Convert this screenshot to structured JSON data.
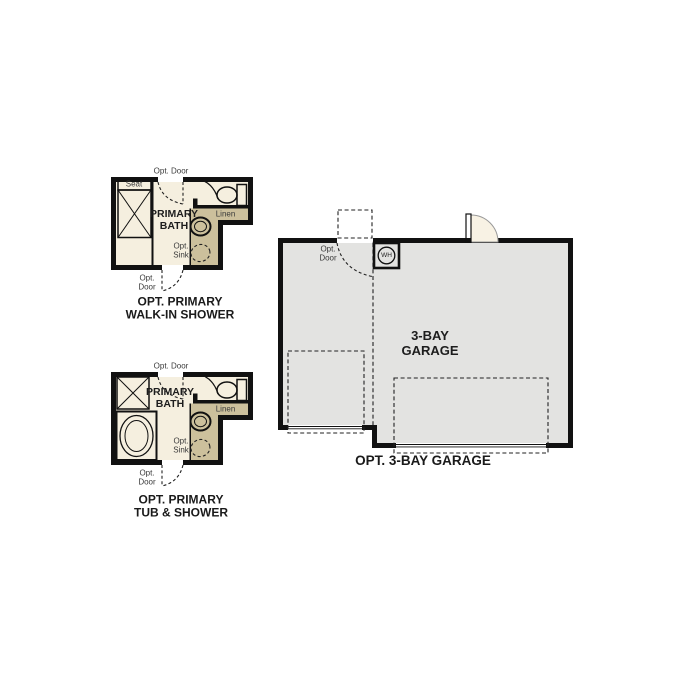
{
  "colors": {
    "wall_black": "#111111",
    "bath_floor_cream": "#f5efdf",
    "garage_floor_gray": "#e3e3e1",
    "cabinet_tan": "#ccc09c",
    "fixture_blue": "#b9d0e8",
    "door_swing_cream": "#f8f2e4",
    "background": "#ffffff"
  },
  "plan_walk_in_shower": {
    "labels": {
      "opt_door_top": "Opt. Door",
      "seat": "Seat",
      "room": "PRIMARY\nBATH",
      "linen": "Linen",
      "opt_sink": "Opt.\nSink",
      "opt_door_bottom": "Opt.\nDoor",
      "caption": "OPT. PRIMARY\nWALK-IN SHOWER"
    }
  },
  "plan_tub_shower": {
    "labels": {
      "opt_door_top": "Opt. Door",
      "room": "PRIMARY\nBATH",
      "linen": "Linen",
      "opt_sink": "Opt.\nSink",
      "opt_door_bottom": "Opt.\nDoor",
      "caption": "OPT. PRIMARY\nTUB & SHOWER"
    }
  },
  "garage": {
    "labels": {
      "opt_door": "Opt.\nDoor",
      "water_heater": "WH",
      "room": "3-BAY\nGARAGE",
      "caption": "OPT. 3-BAY GARAGE"
    }
  }
}
